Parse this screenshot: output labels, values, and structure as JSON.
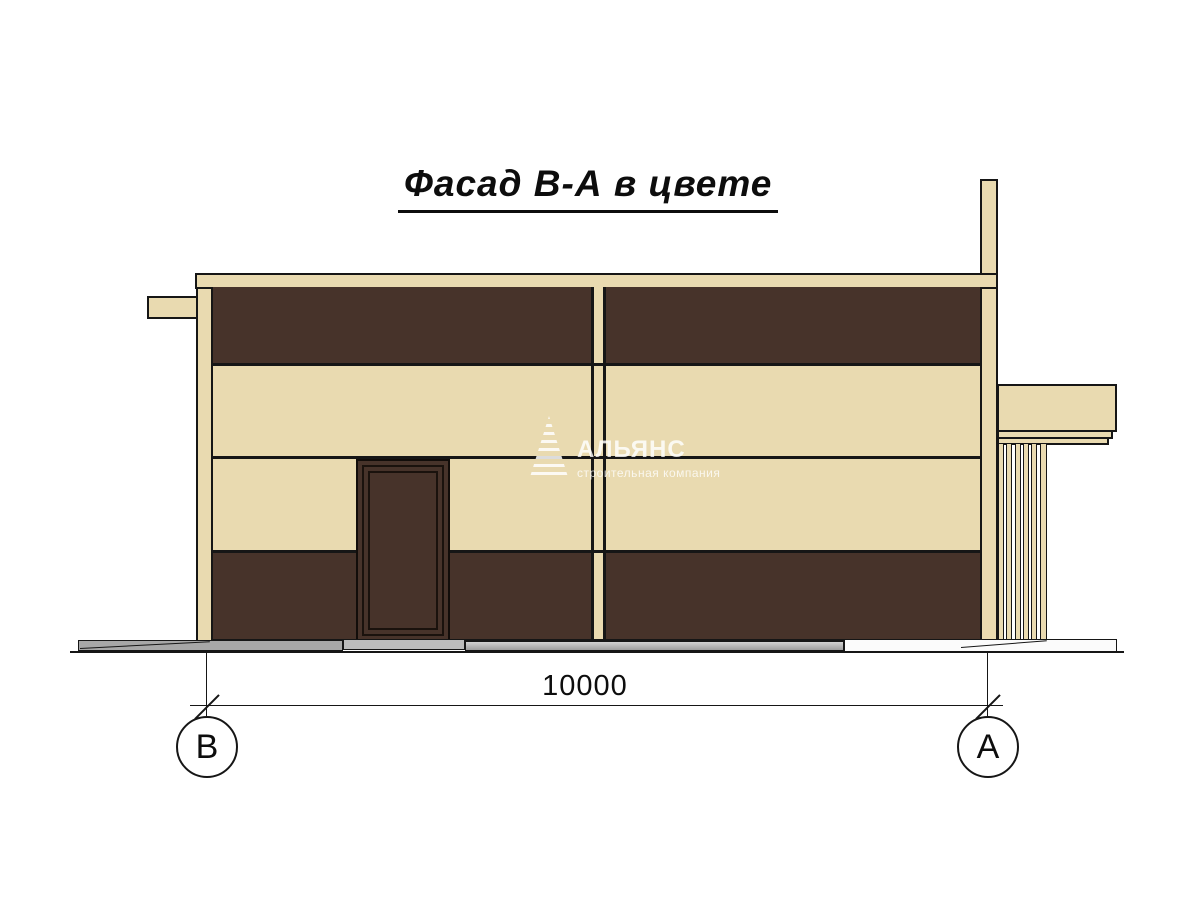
{
  "drawing": {
    "title": "Фасад В-А в цвете",
    "dimension": {
      "value": "10000"
    },
    "axes": [
      {
        "label": "В"
      },
      {
        "label": "А"
      }
    ],
    "watermark": {
      "name": "АЛЬЯНС",
      "subtitle": "строительная компания"
    },
    "colors": {
      "background": "#ffffff",
      "facade_cream": "#e9dab0",
      "facade_brown": "#47332a",
      "plinth_gray": "#a7a7a7",
      "line_black": "#161616"
    }
  }
}
